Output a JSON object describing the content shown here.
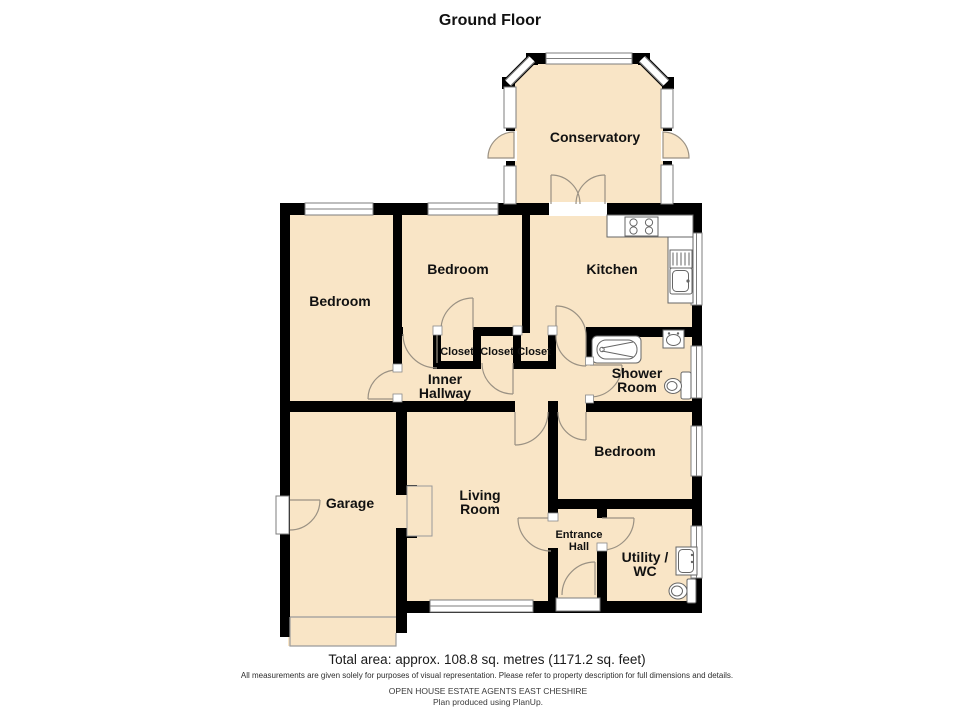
{
  "title": "Ground Floor",
  "rooms": {
    "conservatory": "Conservatory",
    "kitchen": "Kitchen",
    "bedroom1": "Bedroom",
    "bedroom2": "Bedroom",
    "bedroom3": "Bedroom",
    "closet1": "Closet",
    "closet2": "Closet",
    "closet3": "Closet",
    "inner_hallway_line1": "Inner",
    "inner_hallway_line2": "Hallway",
    "shower_room_line1": "Shower",
    "shower_room_line2": "Room",
    "living_room_line1": "Living",
    "living_room_line2": "Room",
    "garage": "Garage",
    "entrance_hall_line1": "Entrance",
    "entrance_hall_line2": "Hall",
    "utility_wc_line1": "Utility /",
    "utility_wc_line2": "WC"
  },
  "footer": {
    "total_area": "Total area: approx. 108.8 sq. metres (1171.2 sq. feet)",
    "disclaimer": "All measurements are given solely for purposes of visual representation. Please refer to property description for full dimensions and details.",
    "agent": "OPEN HOUSE ESTATE AGENTS EAST CHESHIRE",
    "produced": "Plan produced using PlanUp."
  },
  "colors": {
    "room_fill": "#F9E5C6",
    "wall": "#000000",
    "window_frame": "#7d7d7d",
    "door_arc": "#9a9183",
    "text_color": "#111111"
  }
}
